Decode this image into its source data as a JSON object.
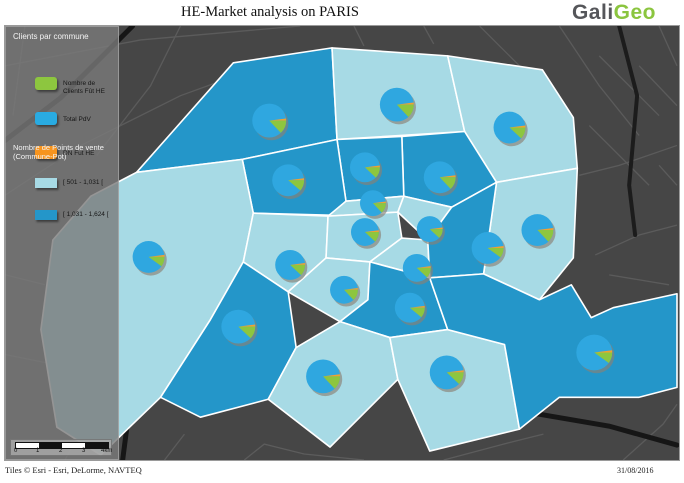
{
  "header": {
    "title": "HE-Market analysis on PARIS",
    "logo_part1": "Gali",
    "logo_part2": "Geo"
  },
  "legend": {
    "title": "Clients par commune",
    "pie_items": [
      {
        "label": "Nombre de Clients Fût HE",
        "color": "#8dc63f"
      },
      {
        "label": "Total PdV",
        "color": "#29abe2"
      },
      {
        "label": "DN Fut HE",
        "color": "#f7941e"
      }
    ],
    "choropleth": {
      "title_line1": "Nombre de Points de vente",
      "title_line2": "(Commune-Pot)",
      "classes": [
        {
          "label": "[ 501 - 1,031 [",
          "color": "#a7dae5"
        },
        {
          "label": "[ 1,031 - 1,624 [",
          "color": "#2496c9"
        }
      ]
    },
    "scalebar": {
      "ticks": [
        "0",
        "1",
        "2",
        "3",
        "4km"
      ]
    }
  },
  "footer": {
    "attribution": "Tiles © Esri - Esri, DeLorme, NAVTEQ",
    "date": "31/08/2016"
  },
  "map": {
    "colors": {
      "basemap": "#464646",
      "district_light": "#a7dae5",
      "district_dark": "#2496c9",
      "district_border": "#ffffff",
      "pie_blue": "#2fa7e0",
      "pie_green": "#8dc63f",
      "pie_orange": "#f0a132",
      "pie_shadow": "#8b8174"
    },
    "districts": [
      {
        "id": "17",
        "shade": "dark",
        "points": "233,62 332,47 337,139 242,159 136,172"
      },
      {
        "id": "18",
        "shade": "light",
        "points": "332,47 448,55 465,131 337,139"
      },
      {
        "id": "19",
        "shade": "light",
        "points": "448,55 543,69 574,117 578,168 497,182 465,131"
      },
      {
        "id": "20",
        "shade": "light",
        "points": "497,182 578,168 574,258 540,300 484,274"
      },
      {
        "id": "10",
        "shade": "dark",
        "points": "402,136 465,131 497,182 452,207 404,196"
      },
      {
        "id": "9",
        "shade": "dark",
        "points": "337,139 402,136 404,196 346,201"
      },
      {
        "id": "8",
        "shade": "dark",
        "points": "242,159 337,139 346,201 330,215 253,213"
      },
      {
        "id": "16",
        "shade": "light",
        "points": "136,172 242,159 253,213 243,262 210,320 160,398 100,456 56,428 40,330 52,240 90,196"
      },
      {
        "id": "7",
        "shade": "light",
        "points": "253,213 328,216 326,258 288,292 243,262"
      },
      {
        "id": "2",
        "shade": "light",
        "points": "346,201 404,196 398,212 328,216"
      },
      {
        "id": "1",
        "shade": "light",
        "points": "328,216 398,212 402,238 370,262 326,258"
      },
      {
        "id": "3",
        "shade": "light",
        "points": "404,196 452,207 428,240 398,212"
      },
      {
        "id": "4",
        "shade": "light",
        "points": "402,238 428,240 430,278 370,262"
      },
      {
        "id": "11",
        "shade": "dark",
        "points": "452,207 497,182 484,274 430,278 428,240"
      },
      {
        "id": "6",
        "shade": "light",
        "points": "326,258 370,262 368,300 340,322 288,292"
      },
      {
        "id": "5",
        "shade": "dark",
        "points": "370,262 430,278 448,330 390,338 340,322 368,300"
      },
      {
        "id": "15",
        "shade": "dark",
        "points": "243,262 288,292 296,348 268,400 200,418 160,398 210,320"
      },
      {
        "id": "14",
        "shade": "light",
        "points": "296,348 340,322 390,338 398,380 330,448 268,400"
      },
      {
        "id": "13",
        "shade": "light",
        "points": "390,338 448,330 505,345 520,430 430,452 398,380"
      },
      {
        "id": "12",
        "shade": "dark",
        "points": "430,278 484,274 540,300 572,285 592,318 614,308 678,294 678,388 640,398 560,398 520,430 505,345 448,330"
      }
    ],
    "pies": [
      {
        "arr": "17",
        "x": 269,
        "y": 120,
        "r": 17,
        "green_pct": 13,
        "orange_pct": 2
      },
      {
        "arr": "18",
        "x": 397,
        "y": 104,
        "r": 17,
        "green_pct": 13,
        "orange_pct": 2
      },
      {
        "arr": "19",
        "x": 510,
        "y": 127,
        "r": 16,
        "green_pct": 12,
        "orange_pct": 2
      },
      {
        "arr": "8",
        "x": 288,
        "y": 180,
        "r": 16,
        "green_pct": 11,
        "orange_pct": 2
      },
      {
        "arr": "9",
        "x": 365,
        "y": 167,
        "r": 15,
        "green_pct": 12,
        "orange_pct": 2
      },
      {
        "arr": "10",
        "x": 440,
        "y": 177,
        "r": 16,
        "green_pct": 13,
        "orange_pct": 2
      },
      {
        "arr": "2",
        "x": 373,
        "y": 203,
        "r": 13,
        "green_pct": 13,
        "orange_pct": 2
      },
      {
        "arr": "1",
        "x": 365,
        "y": 232,
        "r": 14,
        "green_pct": 12,
        "orange_pct": 2
      },
      {
        "arr": "3",
        "x": 430,
        "y": 229,
        "r": 13,
        "green_pct": 12,
        "orange_pct": 2
      },
      {
        "arr": "4",
        "x": 417,
        "y": 268,
        "r": 14,
        "green_pct": 12,
        "orange_pct": 2
      },
      {
        "arr": "7",
        "x": 290,
        "y": 265,
        "r": 15,
        "green_pct": 12,
        "orange_pct": 2
      },
      {
        "arr": "6",
        "x": 344,
        "y": 290,
        "r": 14,
        "green_pct": 13,
        "orange_pct": 2
      },
      {
        "arr": "5",
        "x": 410,
        "y": 308,
        "r": 15,
        "green_pct": 11,
        "orange_pct": 2
      },
      {
        "arr": "11",
        "x": 488,
        "y": 248,
        "r": 16,
        "green_pct": 10,
        "orange_pct": 2
      },
      {
        "arr": "20",
        "x": 538,
        "y": 230,
        "r": 16,
        "green_pct": 13,
        "orange_pct": 2
      },
      {
        "arr": "16",
        "x": 148,
        "y": 257,
        "r": 16,
        "green_pct": 10,
        "orange_pct": 2
      },
      {
        "arr": "15",
        "x": 238,
        "y": 327,
        "r": 17,
        "green_pct": 12,
        "orange_pct": 2
      },
      {
        "arr": "14",
        "x": 323,
        "y": 377,
        "r": 17,
        "green_pct": 13,
        "orange_pct": 2
      },
      {
        "arr": "13",
        "x": 447,
        "y": 373,
        "r": 17,
        "green_pct": 12,
        "orange_pct": 2
      },
      {
        "arr": "12",
        "x": 595,
        "y": 353,
        "r": 18,
        "green_pct": 10,
        "orange_pct": 2
      }
    ]
  }
}
